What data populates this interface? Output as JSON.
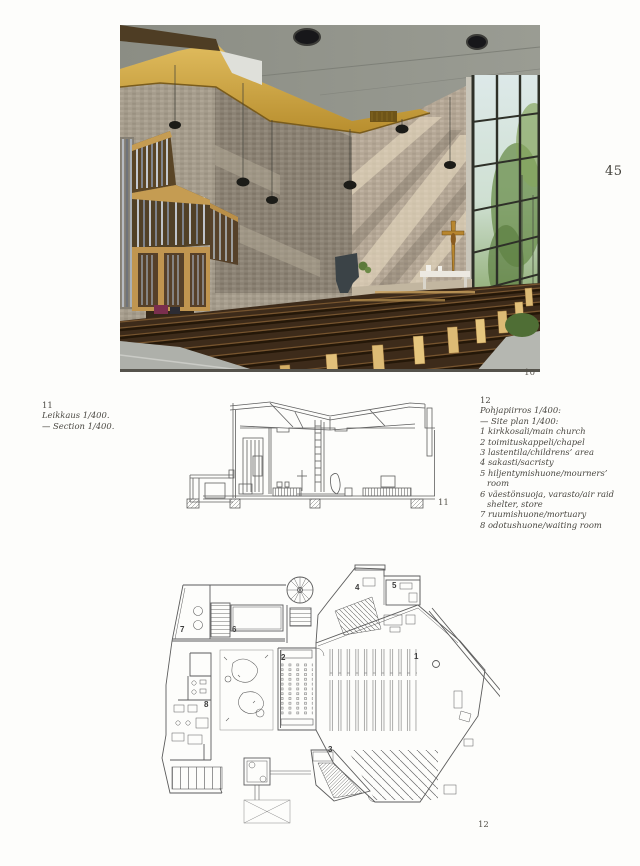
{
  "page": {
    "number": "45"
  },
  "photo": {
    "figure_label": "10",
    "subject": "church-interior-with-organ-pews-and-window-wall"
  },
  "captions": {
    "left": {
      "number": "11",
      "lines": [
        "Leikkaus 1/400.",
        "— Section 1/400."
      ]
    },
    "right": {
      "number": "12",
      "title_fi": "Pohjapiirros 1/400:",
      "title_en": "— Site plan 1/400:",
      "items": [
        "1 kirkkosali/main church",
        "2 toimituskappeli/chapel",
        "3 lastentila/childrens’ area",
        "4 sakasti/sacristy",
        "5 hiljentymishuone/mourners’ room",
        "6 väestönsuoja, varasto/air raid shelter, store",
        "7 ruumishuone/mortuary",
        "8 odotushuone/waiting room"
      ]
    }
  },
  "figures": {
    "section": {
      "label": "11"
    },
    "plan": {
      "label": "12",
      "room_numbers": [
        "1",
        "2",
        "3",
        "4",
        "5",
        "6",
        "7",
        "8"
      ]
    }
  },
  "colors": {
    "paper": "#fdfdfb",
    "ink": "#4a4842",
    "drawing_line": "#616161",
    "concrete_ceiling": "#90928a",
    "wood_band": "#c89f3e",
    "brick_light": "#b4a795",
    "brick_dark": "#8b8274",
    "window_foliage": "#6d8f4f",
    "pew_dark": "#3d2b1a",
    "pew_end_light": "#ddbb75",
    "crucifix_gold": "#b8862e"
  }
}
